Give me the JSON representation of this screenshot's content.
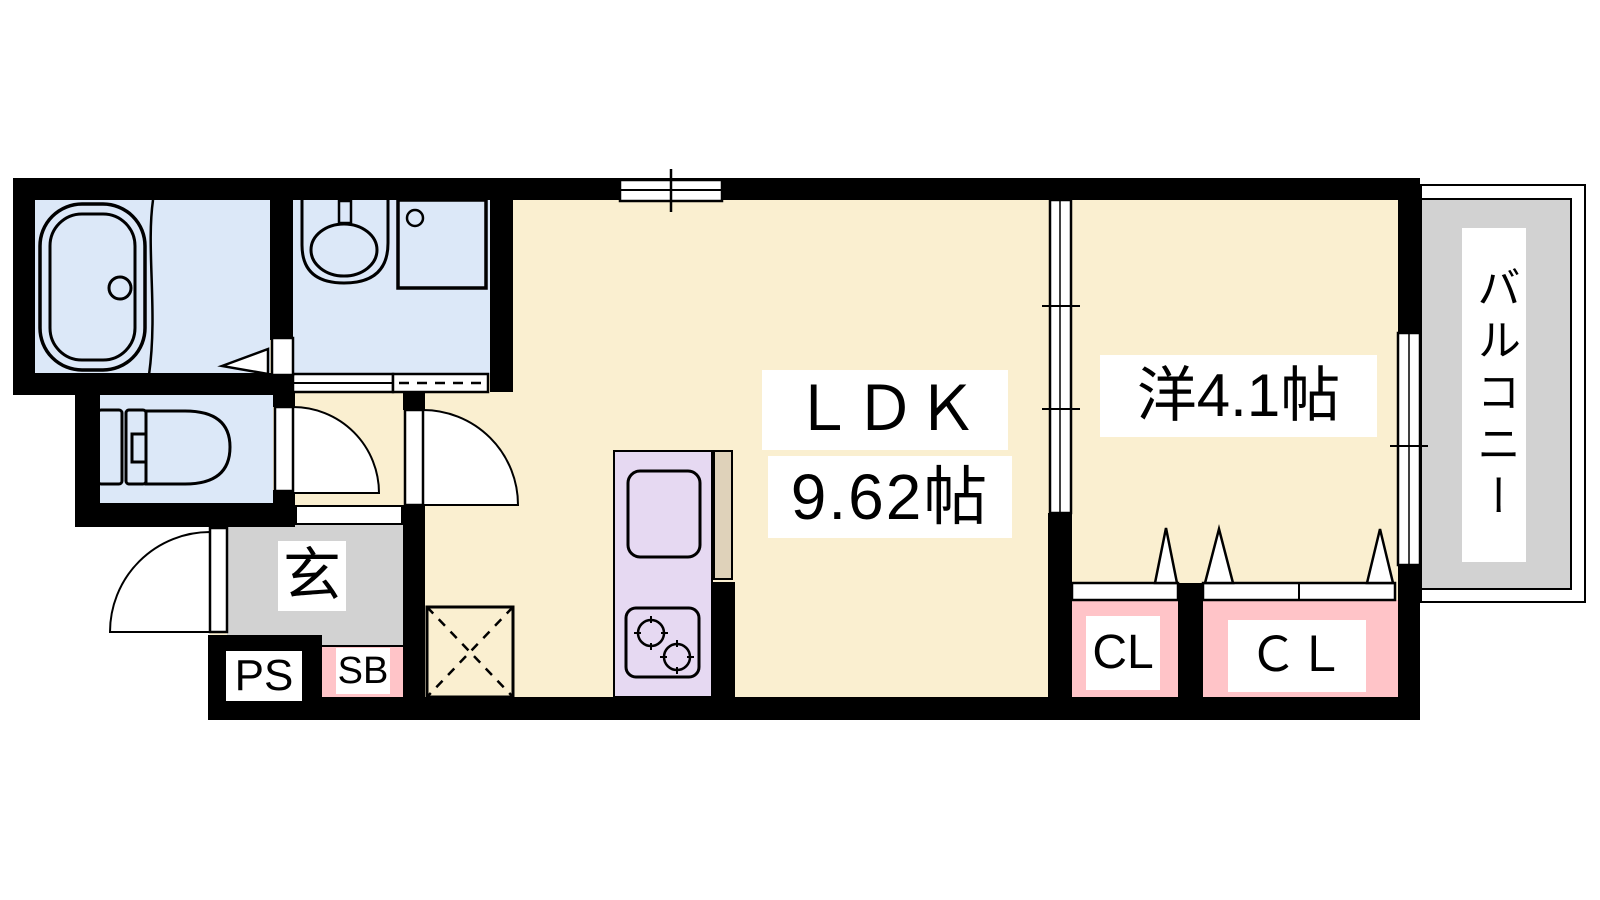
{
  "plan": {
    "type": "japanese-apartment-floor-plan",
    "rooms": {
      "ldk": {
        "name": "ＬＤＫ",
        "size": "9.62帖"
      },
      "western_room": {
        "name": "洋4.1帖"
      },
      "balcony": {
        "name": "バルコニー"
      },
      "entrance": {
        "name": "玄"
      },
      "pipe_space": {
        "name": "PS"
      },
      "shoe_box": {
        "name": "SB"
      },
      "closet_small": {
        "name": "CL"
      },
      "closet_large": {
        "name": "ＣＬ"
      }
    },
    "fixtures": [
      "bathtub",
      "shower-partition",
      "washbasin",
      "washing-machine-pan",
      "toilet",
      "kitchen-sink",
      "gas-stove",
      "washing-machine-space",
      "entrance-door",
      "toilet-door",
      "ldk-door",
      "bathroom-folding-door",
      "sliding-partition",
      "balcony-window",
      "top-window",
      "closet-folding-doors"
    ],
    "colors": {
      "floor_cream": "#FAEFD0",
      "wet_blue": "#DCE8F8",
      "kitchen_purple": "#E6D9F2",
      "counter_tan": "#DFD2BA",
      "closet_pink": "#FFC4C8",
      "entrance_gray": "#D2D2D2",
      "balcony_gray": "#D2D2D2",
      "wall_black": "#000000",
      "label_bg": "#FFFFFF"
    }
  }
}
